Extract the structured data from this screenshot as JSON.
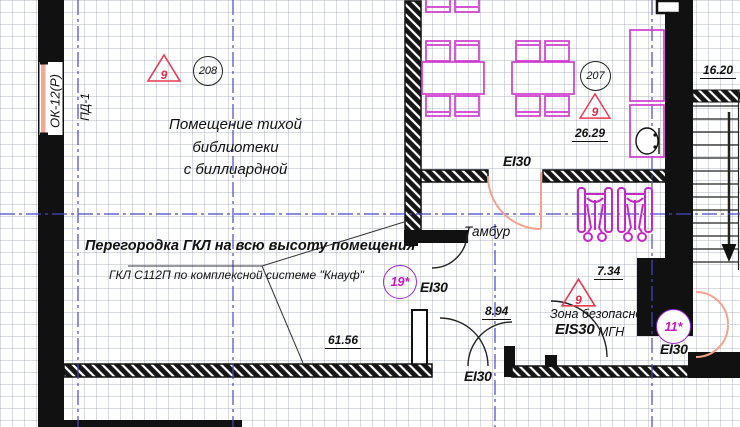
{
  "drawing": {
    "axis_labels": {
      "window_mark": "ОК-12(Р)",
      "axis_mark": "ПД-1"
    },
    "rooms": {
      "library": {
        "title_line1": "Помещение тихой",
        "title_line2": "библиотеки",
        "title_line3": "с биллиардной"
      },
      "tambur": "Тамбур",
      "safety_zone": {
        "line1": "Зона безопасности",
        "line2": "МГН"
      }
    },
    "notes": {
      "partition_title": "Перегородка ГКЛ на всю высоту помещения",
      "partition_spec": "ГКЛ С112П по комплексной системе \"Кнауф\""
    },
    "fire_ratings": {
      "tambur_door": "EI30",
      "mid_door": "EI30",
      "bottom_door": "EI30",
      "right_door": "EI30",
      "safety_zone": "EIS30"
    },
    "markers": {
      "triangle_library": "9",
      "triangle_dining": "9",
      "triangle_zone": "9",
      "room_circle_library": "208",
      "room_circle_dining": "207",
      "node_19": "19*",
      "node_11": "11*"
    },
    "dimensions": {
      "dining_area": "26.29",
      "stairs": "16.20",
      "corridor": "7.34",
      "vestibule": "8.94",
      "library_area": "61.56"
    },
    "colors": {
      "furniture_magenta": "#cf3ccf",
      "marker_red": "#e83a52",
      "axis_blue": "#4747c9",
      "door_salmon": "#f2a28d",
      "node_purple": "#9a27d2",
      "node_text": "#c813c8"
    }
  }
}
